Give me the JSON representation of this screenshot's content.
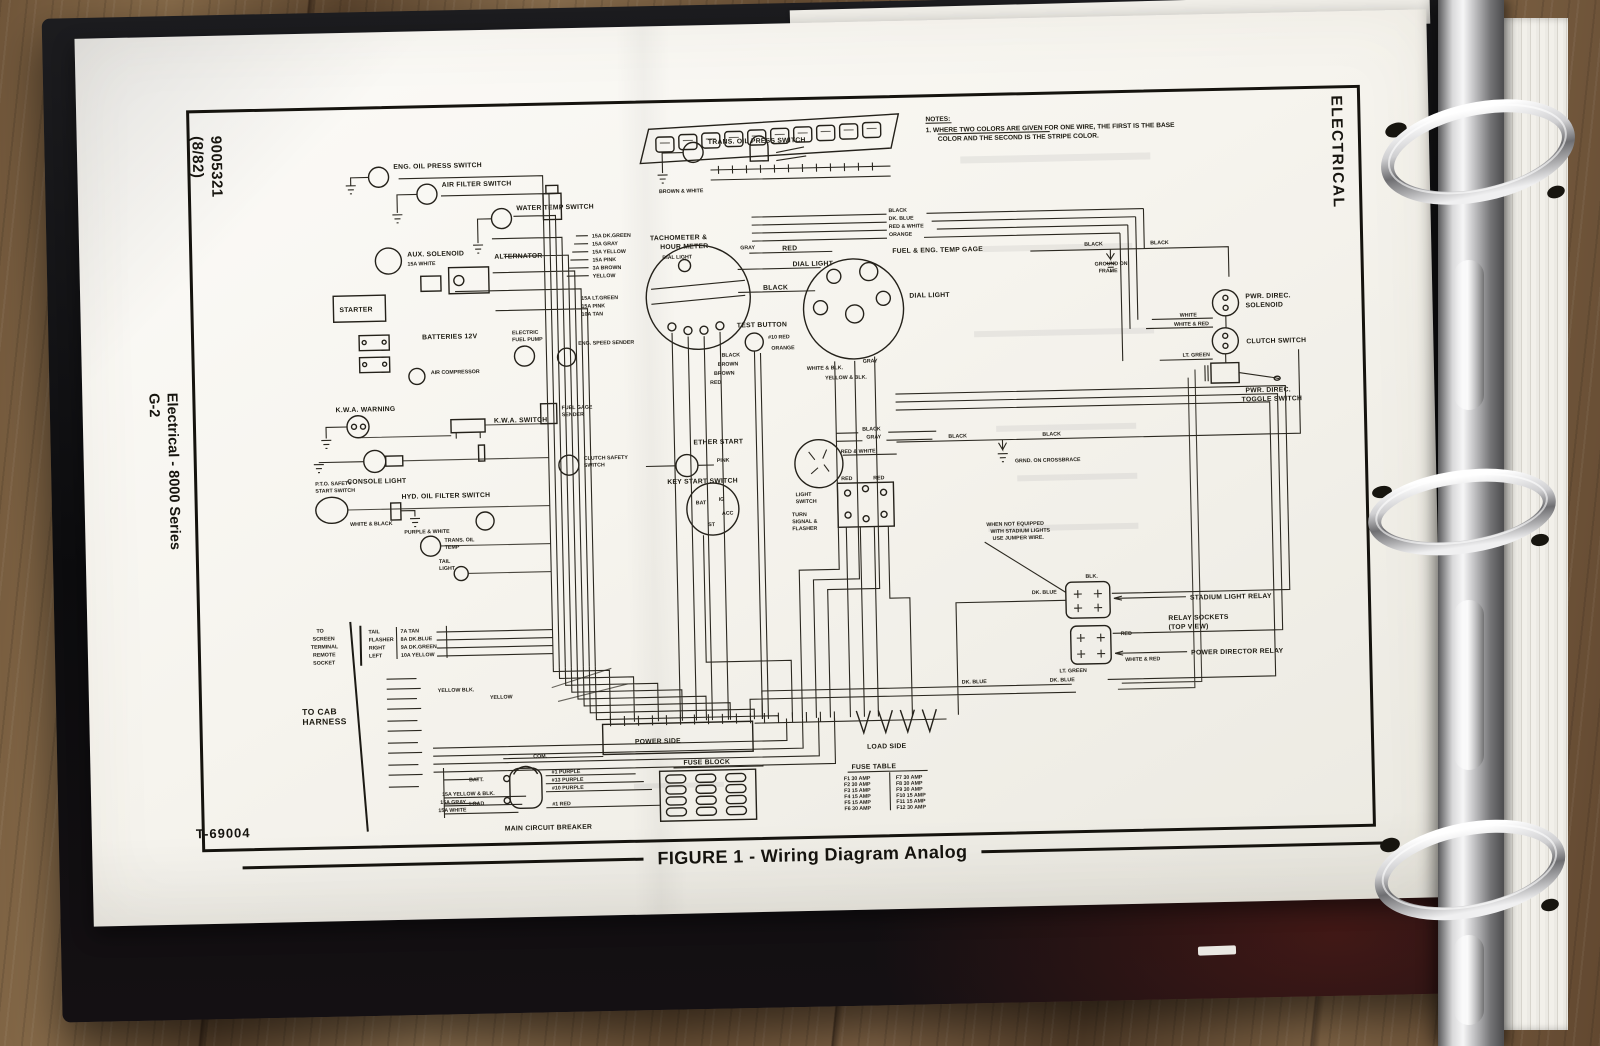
{
  "binder": {
    "side_tab": "ELECTRICAL"
  },
  "page": {
    "doc_number": "9005321",
    "doc_revision": "(8/82)",
    "section": "Electrical - 8000 Series",
    "page_number": "G-2",
    "drawing_number": "T-69004",
    "caption": "FIGURE 1 - Wiring Diagram Analog"
  },
  "notes": {
    "title": "NOTES:",
    "line1": "1.  WHERE TWO COLORS ARE GIVEN FOR ONE WIRE, THE FIRST IS THE BASE",
    "line2": "COLOR AND THE SECOND IS THE STRIPE COLOR."
  },
  "labels": {
    "eng_oil_press": "ENG. OIL PRESS SWITCH",
    "air_filter": "AIR FILTER SWITCH",
    "water_temp": "WATER TEMP SWITCH",
    "trans_oil_press": "TRANS. OIL PRESS SWITCH",
    "aux_solenoid": "AUX. SOLENOID",
    "alternator": "ALTERNATOR",
    "starter": "STARTER",
    "batteries": "BATTERIES 12V",
    "air_compressor": "AIR COMPRESSOR",
    "electric_fuel_pump_1": "ELECTRIC",
    "electric_fuel_pump_2": "FUEL PUMP",
    "eng_speed_sender": "ENG. SPEED SENDER",
    "fuel_gage_sender_1": "FUEL GAGE",
    "fuel_gage_sender_2": "SENDER",
    "clutch_safety_1": "CLUTCH SAFETY",
    "clutch_safety_2": "SWITCH",
    "kwa_warning": "K.W.A. WARNING",
    "kwa_switch": "K.W.A. SWITCH",
    "console_light": "CONSOLE LIGHT",
    "pto_1": "P.T.O. SAFETY",
    "pto_2": "START SWITCH",
    "hyd_oil_filter": "HYD. OIL FILTER SWITCH",
    "trans_oil_temp_1": "TRANS. OIL",
    "trans_oil_temp_2": "TEMP",
    "tail_light_1": "TAIL",
    "tail_light_2": "LIGHT",
    "tach_1": "TACHOMETER &",
    "tach_2": "HOUR METER",
    "dial_light": "DIAL LIGHT",
    "test_button": "TEST BUTTON",
    "fuel_temp_gage": "FUEL & ENG. TEMP GAGE",
    "ether_start": "ETHER START",
    "key_start": "KEY START SWITCH",
    "light_switch_1": "LIGHT",
    "light_switch_2": "SWITCH",
    "turn_1": "TURN",
    "turn_2": "SIGNAL &",
    "turn_3": "FLASHER",
    "pwr_solenoid_1": "PWR. DIREC.",
    "pwr_solenoid_2": "SOLENOID",
    "clutch_switch": "CLUTCH SWITCH",
    "toggle_1": "PWR. DIREC.",
    "toggle_2": "TOGGLE SWITCH",
    "ground_frame_1": "GROUND ON",
    "ground_frame_2": "FRAME",
    "grnd_crossbrace": "GRND. ON CROSSBRACE",
    "stadium_note_1": "WHEN NOT EQUIPPED",
    "stadium_note_2": "WITH STADIUM LIGHTS",
    "stadium_note_3": "USE JUMPER WIRE.",
    "stadium_relay": "STADIUM LIGHT RELAY",
    "relay_sockets_1": "RELAY SOCKETS",
    "relay_sockets_2": "(TOP VIEW)",
    "power_director_relay": "POWER DIRECTOR RELAY",
    "main_breaker": "MAIN CIRCUIT BREAKER"
  },
  "wires": {
    "black": "BLACK",
    "dk_blue": "DK. BLUE",
    "red_white": "RED & WHITE",
    "orange": "ORANGE",
    "red": "RED",
    "gray": "GRAY",
    "brown": "BROWN",
    "white": "WHITE",
    "pink": "PINK",
    "white_red": "WHITE & RED",
    "lt_green": "LT. GREEN",
    "white_blk": "WHITE & BLK.",
    "yellow_blk": "YELLOW & BLK.",
    "purple_white": "PURPLE & WHITE",
    "white_black": "WHITE & BLACK",
    "brown_white": "BROWN & WHITE",
    "num10_red": "#10 RED",
    "blk": "BLK.",
    "yellow": "YELLOW",
    "yellow_blk2": "YELLOW BLK.",
    "g15_dkgreen": "15A DK.GREEN",
    "g15_gray": "15A GRAY",
    "g15_yellow": "15A YELLOW",
    "g15_pink": "15A PINK",
    "g3_brown": "3A BROWN",
    "g15_ltgreen": "15A LT.GREEN",
    "g10_tan": "10A TAN",
    "g15_yellow_blk": "15A YELLOW & BLK.",
    "g15_white": "15A WHITE"
  },
  "key_switch": {
    "bat": "BAT",
    "ig": "IG",
    "acc": "ACC",
    "st": "ST"
  },
  "screen_socket": {
    "intro_1": "TO",
    "intro_2": "SCREEN",
    "intro_3": "TERMINAL",
    "intro_4": "REMOTE",
    "intro_5": "SOCKET",
    "rows": [
      {
        "name": "TAIL",
        "wire": "7A TAN"
      },
      {
        "name": "FLASHER",
        "wire": "8A DK.BLUE"
      },
      {
        "name": "RIGHT",
        "wire": "9A DK.GREEN"
      },
      {
        "name": "LEFT",
        "wire": "10A YELLOW"
      }
    ]
  },
  "cab_harness": {
    "line1": "TO CAB",
    "line2": "HARNESS"
  },
  "terminal_strip": {
    "power": "POWER SIDE",
    "load": "LOAD SIDE"
  },
  "fuse_block": {
    "title": "FUSE BLOCK"
  },
  "fuse_table": {
    "title": "FUSE  TABLE",
    "rows": [
      {
        "l": "F1  30 AMP",
        "r": "F7  30 AMP"
      },
      {
        "l": "F2  30 AMP",
        "r": "F8  30 AMP"
      },
      {
        "l": "F3  15 AMP",
        "r": "F9  30 AMP"
      },
      {
        "l": "F4  15 AMP",
        "r": "F10 15 AMP"
      },
      {
        "l": "F5  15 AMP",
        "r": "F11 15 AMP"
      },
      {
        "l": "F6  30 AMP",
        "r": "F12 30 AMP"
      }
    ]
  },
  "breaker": {
    "batt": "BATT.",
    "load": "LOAD",
    "com": "COM.",
    "w1": "#1 PURPLE",
    "w2": "#13 PURPLE",
    "w3": "#10 PURPLE",
    "w4": "#1 RED"
  }
}
